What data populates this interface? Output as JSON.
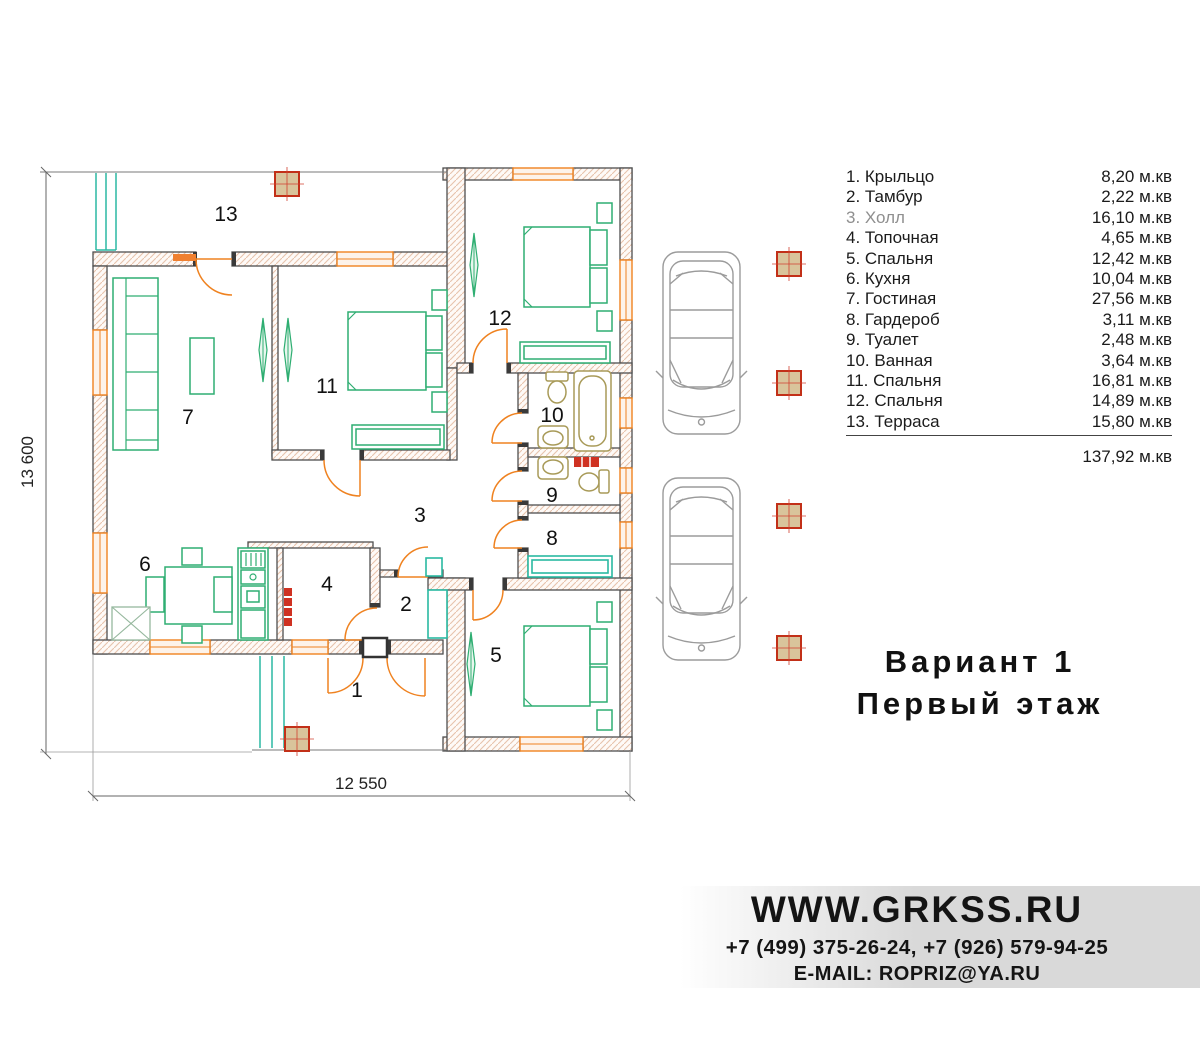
{
  "legend": {
    "rows": [
      {
        "label": "1. Крыльцо",
        "area": "8,20 м.кв"
      },
      {
        "label": "2. Тамбур",
        "area": "2,22 м.кв"
      },
      {
        "label": "3. Холл",
        "area": "16,10 м.кв"
      },
      {
        "label": "4. Топочная",
        "area": "4,65 м.кв"
      },
      {
        "label": "5. Спальня",
        "area": "12,42 м.кв"
      },
      {
        "label": "6. Кухня",
        "area": "10,04 м.кв"
      },
      {
        "label": "7. Гостиная",
        "area": "27,56 м.кв"
      },
      {
        "label": "8. Гардероб",
        "area": "3,11 м.кв"
      },
      {
        "label": "9. Туалет",
        "area": "2,48 м.кв"
      },
      {
        "label": "10. Ванная",
        "area": "3,64 м.кв"
      },
      {
        "label": "11. Спальня",
        "area": "16,81 м.кв"
      },
      {
        "label": "12. Спальня",
        "area": "14,89 м.кв"
      },
      {
        "label": "13. Терраса",
        "area": "15,80 м.кв"
      }
    ],
    "total": "137,92 м.кв"
  },
  "title": {
    "line1": "Вариант 1",
    "line2": "Первый этаж"
  },
  "footer": {
    "website": "WWW.GRKSS.RU",
    "phones": "+7 (499) 375-26-24, +7 (926) 579-94-25",
    "email": "E-MAIL: ROPRIZ@YA.RU"
  },
  "plan": {
    "dim_width": "12 550",
    "dim_height": "13 600",
    "rooms": {
      "r1": "1",
      "r2": "2",
      "r3": "3",
      "r4": "4",
      "r5": "5",
      "r6": "6",
      "r7": "7",
      "r8": "8",
      "r9": "9",
      "r10": "10",
      "r11": "11",
      "r12": "12",
      "r13": "13"
    },
    "colors": {
      "walls": "#4f4f4f",
      "wall_hatch": "#e7c3ac",
      "furniture_green": "#2fae72",
      "terrace_teal": "#2ab9a2",
      "doors_windows_orange": "#ef8220",
      "fixtures_tan": "#a89a58",
      "columns_red": "#c23018",
      "columns_fill": "#d9c49b",
      "radiator_red": "#cf3222",
      "car_gray": "#9b9b9b"
    }
  }
}
